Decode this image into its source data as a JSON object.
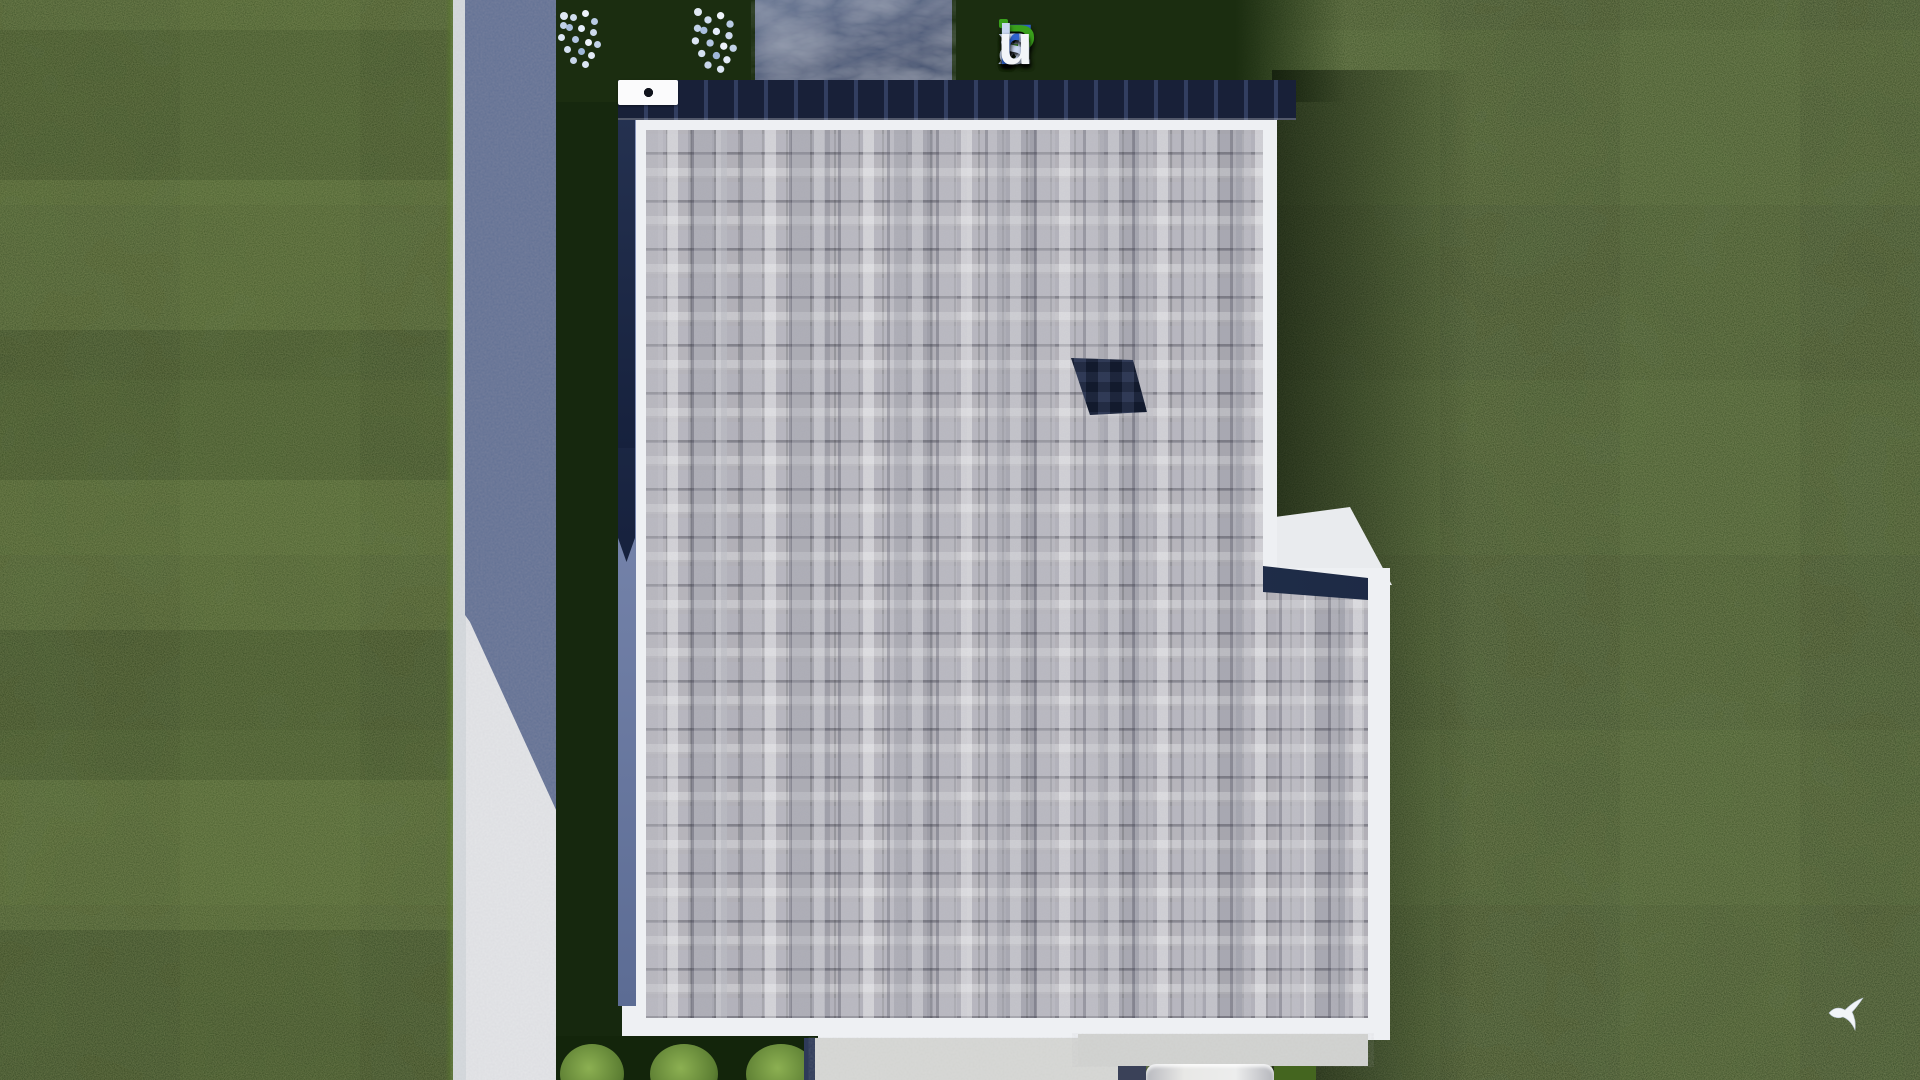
{
  "brand": {
    "text": "FixPlans.ru",
    "letters": [
      {
        "ch": "F",
        "color": "#2f63cd"
      },
      {
        "ch": "i",
        "color": "#c9d6f0",
        "dot": "#3aa01c"
      },
      {
        "ch": "x",
        "color": "#c9d6f0"
      },
      {
        "ch": "P",
        "color": "#3aa01c"
      },
      {
        "ch": "l",
        "color": "#c9d6f0"
      },
      {
        "ch": "a",
        "color": "#c9d6f0"
      },
      {
        "ch": "n",
        "color": "#c9d6f0"
      },
      {
        "ch": "s",
        "color": "#c9d6f0"
      },
      {
        "ch": ".",
        "color": "#2f63cd"
      },
      {
        "ch": "r",
        "color": "#2f63cd"
      },
      {
        "ch": "u",
        "color": "#f3f5f9"
      }
    ]
  },
  "scene": {
    "description": "Aerial top-down 3D render of a flat shingle-roofed house on a lawn plot",
    "chimney_vents": 3,
    "hedge_bushes": 3,
    "flower_bushes": 2
  },
  "colors": {
    "grass-base": "#2c411c",
    "grass-shadow": "#16280e",
    "grass-top-shadow": "#1b2d10",
    "road-lit": "#e4e5e8",
    "road-curb": "#d6dade",
    "road-shadow": "#5c6b91",
    "patio-stone": "#5a6988",
    "roof-fascia": "#eef0f3",
    "roof-band-light": "#93a0c4",
    "roof-band-dark": "#2c3a5c",
    "shingle-base": "#b2b1b8",
    "roof-inset": "#16213d",
    "skylight": "#232f52",
    "hedge-dark": "#13250b",
    "bush-green": "#8cb052",
    "concrete-light": "#d8d9d6"
  }
}
